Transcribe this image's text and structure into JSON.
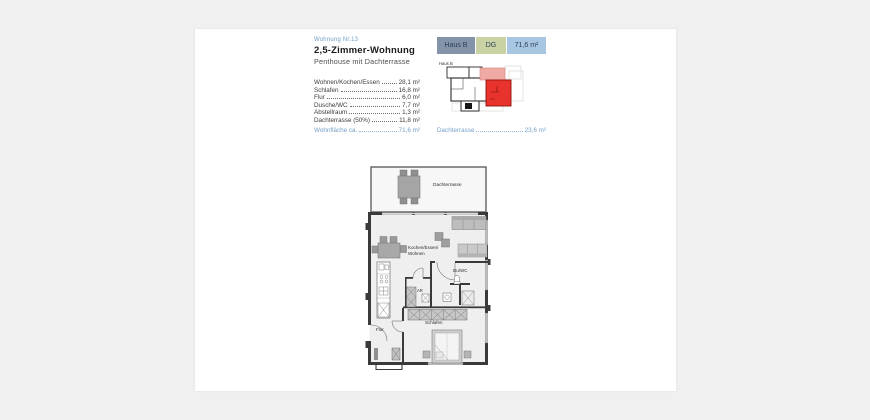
{
  "header": {
    "unit_number": "Wohnung Nr.13",
    "title": "2,5-Zimmer-Wohnung",
    "subtitle": "Penthouse mit Dachterrasse"
  },
  "badges": [
    {
      "label": "Haus B",
      "bg": "#8394a9"
    },
    {
      "label": "DG",
      "bg": "#c8d2a2"
    },
    {
      "label": "71,6 m²",
      "bg": "#a7c6e2"
    }
  ],
  "room_list": {
    "rows": [
      {
        "label": "Wohnen/Kochen/Essen",
        "value": "28,1 m²"
      },
      {
        "label": "Schlafen",
        "value": "16,8 m²"
      },
      {
        "label": "Flur",
        "value": "6,0 m²"
      },
      {
        "label": "Dusche/WC",
        "value": "7,7 m²"
      },
      {
        "label": "Abstellraum",
        "value": "1,3 m²"
      },
      {
        "label": "Dachterrasse (50%)",
        "value": "11,8 m²"
      }
    ],
    "total": {
      "label": "Wohnfläche ca.",
      "value": "71,6 m²"
    },
    "terrace": {
      "label": "Dachterrasse",
      "value": "23,6 m²"
    }
  },
  "minimap": {
    "label": "Haus B",
    "unit_color": "#e7332b",
    "terrace_color": "#f0aaa5"
  },
  "floorplan": {
    "labels": {
      "terrace": "Dachterrasse",
      "living_1": "Kochen/Essen/",
      "living_2": "Wohnen",
      "bath": "Du/WC",
      "storage": "AR",
      "bedroom": "Schlafen",
      "hall": "Flur"
    }
  },
  "colors": {
    "accent_blue": "#74a0c8",
    "wall_dark": "#3a3a3a"
  }
}
